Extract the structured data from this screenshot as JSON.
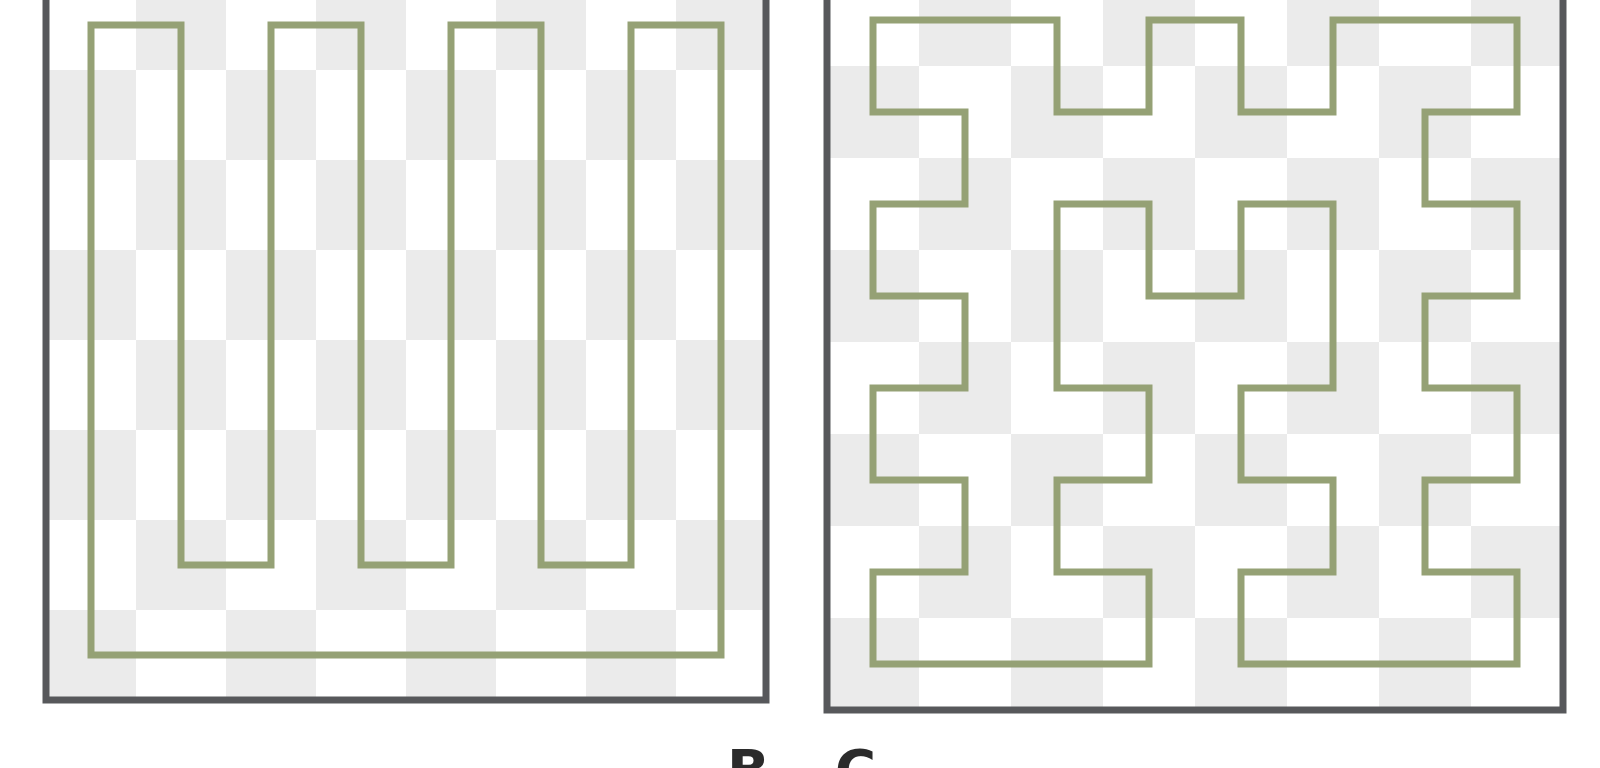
{
  "figure": {
    "background": "#ffffff",
    "colors": {
      "curve": "#95A175",
      "panel_border": "#57585B",
      "checker_light": "#ffffff",
      "checker_dark": "#EBEBEB",
      "caption_text": "#2B2B2B"
    },
    "stroke": {
      "curve_width": 7,
      "border_width": 7
    },
    "panels": [
      {
        "id": "serpentine-loop",
        "name": "serpentine-loop-panel",
        "description": "closed boustrophedon scan cycle",
        "grid": {
          "cols": 8,
          "rows": 8
        },
        "layout": {
          "x": 46,
          "y": -20,
          "cell": 90
        },
        "closed": true,
        "waypoints": [
          [
            0,
            0
          ],
          [
            1,
            0
          ],
          [
            1,
            6
          ],
          [
            2,
            6
          ],
          [
            2,
            0
          ],
          [
            3,
            0
          ],
          [
            3,
            6
          ],
          [
            4,
            6
          ],
          [
            4,
            0
          ],
          [
            5,
            0
          ],
          [
            5,
            6
          ],
          [
            6,
            6
          ],
          [
            6,
            0
          ],
          [
            7,
            0
          ],
          [
            7,
            7
          ],
          [
            0,
            7
          ]
        ]
      },
      {
        "id": "hilbert-loop",
        "name": "hilbert-loop-panel",
        "description": "closed Hilbert/Moore curve cycle",
        "grid": {
          "cols": 8,
          "rows": 8
        },
        "layout": {
          "x": 827,
          "y": -26,
          "cell": 92
        },
        "closed": true,
        "waypoints": [
          [
            0,
            0
          ],
          [
            0,
            1
          ],
          [
            1,
            1
          ],
          [
            1,
            2
          ],
          [
            0,
            2
          ],
          [
            0,
            3
          ],
          [
            1,
            3
          ],
          [
            1,
            4
          ],
          [
            0,
            4
          ],
          [
            0,
            5
          ],
          [
            1,
            5
          ],
          [
            1,
            6
          ],
          [
            0,
            6
          ],
          [
            0,
            7
          ],
          [
            3,
            7
          ],
          [
            3,
            6
          ],
          [
            2,
            6
          ],
          [
            2,
            5
          ],
          [
            3,
            5
          ],
          [
            3,
            4
          ],
          [
            2,
            4
          ],
          [
            2,
            2
          ],
          [
            3,
            2
          ],
          [
            3,
            3
          ],
          [
            4,
            3
          ],
          [
            4,
            2
          ],
          [
            5,
            2
          ],
          [
            5,
            4
          ],
          [
            4,
            4
          ],
          [
            4,
            5
          ],
          [
            5,
            5
          ],
          [
            5,
            6
          ],
          [
            4,
            6
          ],
          [
            4,
            7
          ],
          [
            7,
            7
          ],
          [
            7,
            6
          ],
          [
            6,
            6
          ],
          [
            6,
            5
          ],
          [
            7,
            5
          ],
          [
            7,
            4
          ],
          [
            6,
            4
          ],
          [
            6,
            3
          ],
          [
            7,
            3
          ],
          [
            7,
            2
          ],
          [
            6,
            2
          ],
          [
            6,
            1
          ],
          [
            7,
            1
          ],
          [
            7,
            0
          ],
          [
            5,
            0
          ],
          [
            5,
            1
          ],
          [
            4,
            1
          ],
          [
            4,
            0
          ],
          [
            3,
            0
          ],
          [
            3,
            1
          ],
          [
            2,
            1
          ],
          [
            2,
            0
          ]
        ]
      }
    ],
    "caption": {
      "cropped": true,
      "letters": [
        {
          "char": "B",
          "left": 727
        },
        {
          "char": "C",
          "left": 835
        }
      ]
    }
  }
}
